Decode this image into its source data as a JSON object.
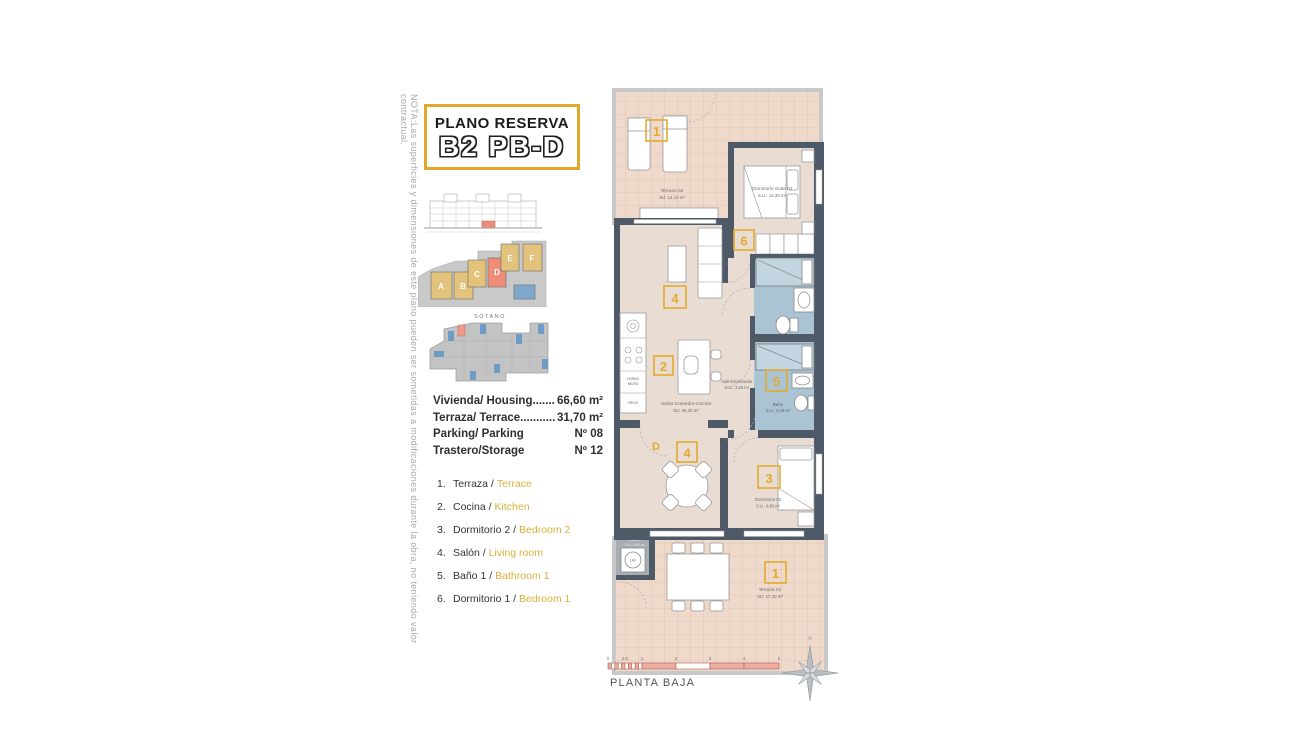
{
  "note_vertical": "NOTA:Las superficies y dimensiones de este plano pueden ser sometidas a modificaciones durante la obra, no teniendo valor contractual.",
  "title_block": {
    "line1": "PLANO RESERVA",
    "line2": "B2 PB-D"
  },
  "site": {
    "sotano_label": "SÓTANO",
    "blocks": {
      "a": "A",
      "b": "B",
      "c": "C",
      "d": "D",
      "e": "E",
      "f": "F"
    }
  },
  "info": {
    "rows": [
      {
        "label": "Vivienda/ Housing.......",
        "value": "66,60 m²"
      },
      {
        "label": "Terraza/ Terrace...........",
        "value": "31,70 m²"
      },
      {
        "label": "Parking/ Parking",
        "value": "Nº 08"
      },
      {
        "label": "Trastero/Storage",
        "value": "Nº 12"
      }
    ]
  },
  "legend": {
    "items": [
      {
        "num": "1.",
        "es": "Terraza /",
        "en": "Terrace"
      },
      {
        "num": "2.",
        "es": "Cocina /",
        "en": "Kitchen"
      },
      {
        "num": "3.",
        "es": "Dormitorio 2 /",
        "en": "Bedroom 2"
      },
      {
        "num": "4.",
        "es": "Salón /",
        "en": "Living room"
      },
      {
        "num": "5.",
        "es": "Baño 1 /",
        "en": "Bathroom 1"
      },
      {
        "num": "6.",
        "es": "Dormitorio 1 /",
        "en": "Bedroom 1"
      }
    ]
  },
  "plan": {
    "terraza02": {
      "name": "Terraza 02",
      "area": "SU: 14,10 m²",
      "badge": "1"
    },
    "suite": {
      "name": "Dormitorio Suite 01",
      "area": "S.U.: 14,30 m²",
      "badge": "6"
    },
    "salon": {
      "name": "Salón-Comedor-Cocina",
      "area": "SU: 26,30 m²",
      "badge": "2"
    },
    "living_badge": "4",
    "hall": {
      "name": "Hall-Distribuidor",
      "area": "S.U.: 3,50 m²"
    },
    "bano": {
      "name": "Baño",
      "area": "S.U.: 3,40 m²",
      "badge": "5"
    },
    "dorm02": {
      "name": "Dormitorio 02",
      "area": "S.U.: 8,80 m²",
      "badge": "3"
    },
    "dining_badge": "4",
    "door_letter": "D",
    "galeria": {
      "name": "Galería",
      "area": "S.U.: 0,80 m²"
    },
    "terraza01": {
      "name": "Terraza 01",
      "area": "SU: 17,40 m²",
      "badge": "1"
    },
    "kitchen": {
      "horno": "HORNO",
      "micro": "MICRO",
      "frigo": "FRIGO",
      "lav": "LAV"
    }
  },
  "footer": {
    "plant": "PLANTA BAJA",
    "ticks": [
      "0",
      "0.5",
      "1",
      "2",
      "3",
      "4",
      "5"
    ],
    "north": "N"
  },
  "colors": {
    "accent_yellow": "#e2ab2f",
    "wall_dark": "#4e5a68",
    "bathroom_blue": "#abc4d4",
    "terrace_floor": "#eed9cb",
    "interior_floor": "#e9dcd2",
    "highlight_red": "#ed8d77",
    "parking_blue": "#7fa8cc"
  }
}
